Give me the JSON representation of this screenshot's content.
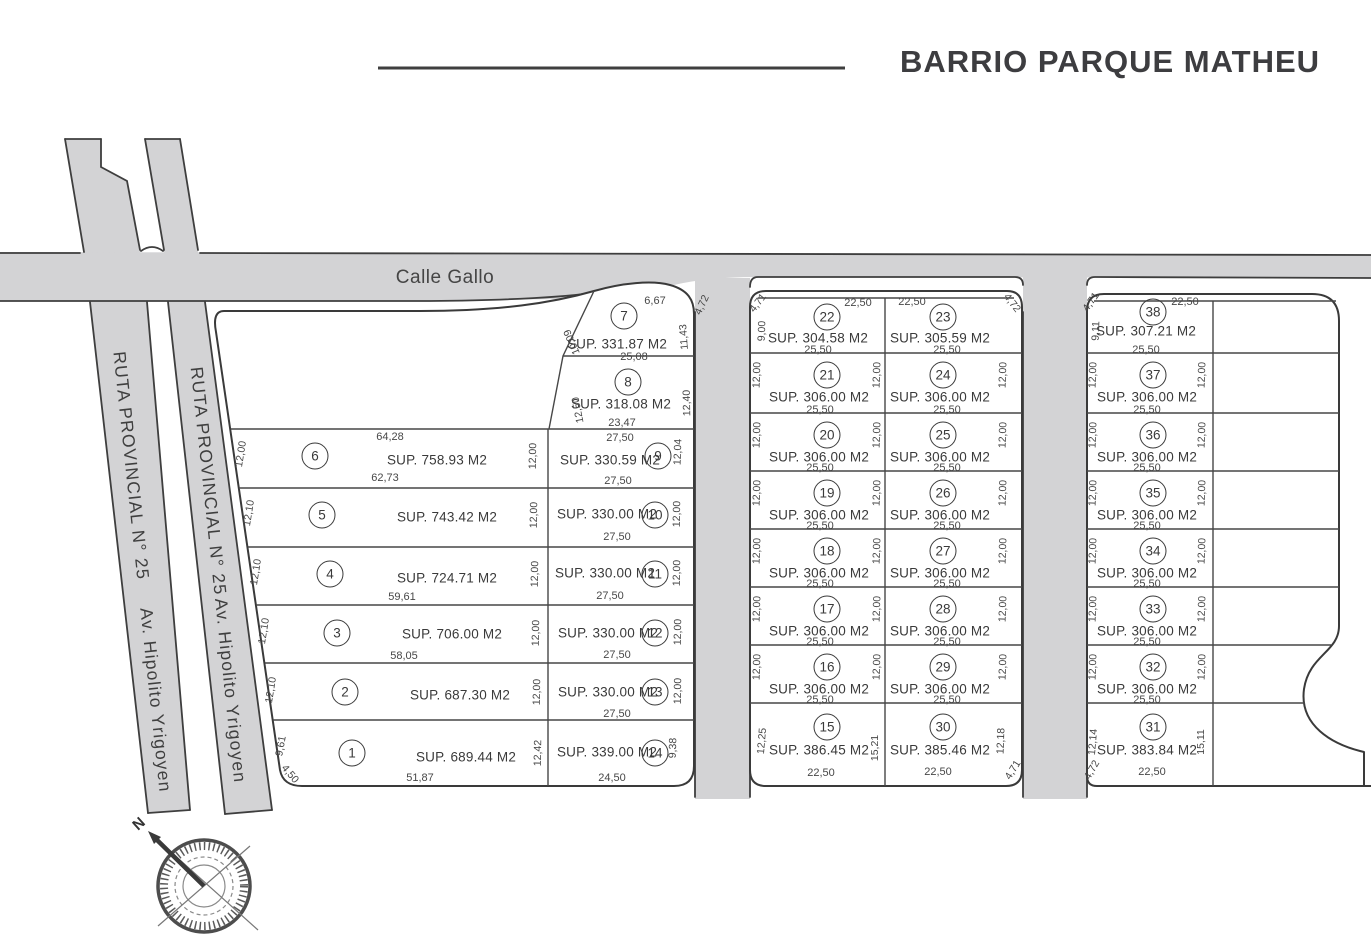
{
  "title": "BARRIO PARQUE MATHEU",
  "roads": {
    "calle_gallo": "Calle Gallo",
    "ruta_west": {
      "part1": "RUTA PROVINCIAL N° 25",
      "part2": "Av. Hipolito Yrigoyen"
    },
    "ruta_east": {
      "part1": "RUTA PROVINCIAL N° 25",
      "part2": "Av. Hipolito Yrigoyen"
    }
  },
  "compass": {
    "north": "N"
  },
  "lots": [
    {
      "number": "1",
      "sup": "SUP. 689.44 M2",
      "dims": {
        "left": "9,61",
        "corner": "4,50",
        "bottom": "51,87"
      }
    },
    {
      "number": "2",
      "sup": "SUP. 687.30 M2",
      "dims": {
        "left": "12,10"
      }
    },
    {
      "number": "3",
      "sup": "SUP. 706.00 M2",
      "dims": {
        "left": "12,10",
        "bottom": "58,05"
      }
    },
    {
      "number": "4",
      "sup": "SUP. 724.71 M2",
      "dims": {
        "left": "12,10",
        "bottom": "59,61"
      }
    },
    {
      "number": "5",
      "sup": "SUP. 743.42 M2",
      "dims": {
        "left": "12,10"
      }
    },
    {
      "number": "6",
      "sup": "SUP. 758.93 M2",
      "dims": {
        "left": "12,00",
        "top": "64,28",
        "bottom": "62,73"
      }
    },
    {
      "number": "7",
      "sup": "SUP. 331.87 M2",
      "dims": {
        "top": "6,67",
        "corner": "4,72",
        "left": "10,09",
        "right": "11,43",
        "bottom": "25,08"
      }
    },
    {
      "number": "8",
      "sup": "SUP. 318.08 M2",
      "dims": {
        "left": "12,50",
        "right": "12,40",
        "bottom": "23,47"
      }
    },
    {
      "number": "9",
      "sup": "SUP. 330.59 M2",
      "dims": {
        "top": "27,50",
        "left": "12,00",
        "right": "12,04",
        "bottom": "27,50"
      }
    },
    {
      "number": "10",
      "sup": "SUP. 330.00 M2",
      "dims": {
        "left": "12,00",
        "right": "12,00",
        "bottom": "27,50"
      }
    },
    {
      "number": "11",
      "sup": "SUP. 330.00 M2",
      "dims": {
        "left": "12,00",
        "right": "12,00",
        "bottom": "27,50"
      }
    },
    {
      "number": "12",
      "sup": "SUP. 330.00 M2",
      "dims": {
        "left": "12,00",
        "right": "12,00",
        "bottom": "27,50"
      }
    },
    {
      "number": "13",
      "sup": "SUP. 330.00 M2",
      "dims": {
        "left": "12,00",
        "right": "12,00",
        "bottom": "27,50"
      }
    },
    {
      "number": "14",
      "sup": "SUP. 339.00 M2",
      "dims": {
        "left": "12,42",
        "right": "9,38",
        "bottom": "24,50"
      }
    },
    {
      "number": "15",
      "sup": "SUP. 386.45 M2",
      "dims": {
        "left": "12,25",
        "right": "15,21",
        "bottom": "22,50"
      }
    },
    {
      "number": "16",
      "sup": "SUP. 306.00 M2",
      "dims": {
        "left": "12,00",
        "right": "12,00",
        "bottom": "25,50"
      }
    },
    {
      "number": "17",
      "sup": "SUP. 306.00 M2",
      "dims": {
        "left": "12,00",
        "right": "12,00",
        "bottom": "25,50"
      }
    },
    {
      "number": "18",
      "sup": "SUP. 306.00 M2",
      "dims": {
        "left": "12,00",
        "right": "12,00",
        "bottom": "25,50"
      }
    },
    {
      "number": "19",
      "sup": "SUP. 306.00 M2",
      "dims": {
        "left": "12,00",
        "right": "12,00",
        "bottom": "25,50"
      }
    },
    {
      "number": "20",
      "sup": "SUP. 306.00 M2",
      "dims": {
        "left": "12,00",
        "right": "12,00",
        "bottom": "25,50"
      }
    },
    {
      "number": "21",
      "sup": "SUP. 306.00 M2",
      "dims": {
        "left": "12,00",
        "right": "12,00",
        "bottom": "25,50"
      }
    },
    {
      "number": "22",
      "sup": "SUP. 304.58 M2",
      "dims": {
        "top": "22,50",
        "corner": "4,71",
        "left": "9,00",
        "bottom": "25,50"
      }
    },
    {
      "number": "23",
      "sup": "SUP. 305.59 M2",
      "dims": {
        "top": "22,50",
        "corner": "4,72",
        "bottom": "25,50"
      }
    },
    {
      "number": "24",
      "sup": "SUP. 306.00 M2",
      "dims": {
        "right": "12,00",
        "bottom": "25,50"
      }
    },
    {
      "number": "25",
      "sup": "SUP. 306.00 M2",
      "dims": {
        "right": "12,00",
        "bottom": "25,50"
      }
    },
    {
      "number": "26",
      "sup": "SUP. 306.00 M2",
      "dims": {
        "right": "12,00",
        "bottom": "25,50"
      }
    },
    {
      "number": "27",
      "sup": "SUP. 306.00 M2",
      "dims": {
        "right": "12,00",
        "bottom": "25,50"
      }
    },
    {
      "number": "28",
      "sup": "SUP. 306.00 M2",
      "dims": {
        "right": "12,00",
        "bottom": "25,50"
      }
    },
    {
      "number": "29",
      "sup": "SUP. 306.00 M2",
      "dims": {
        "right": "12,00",
        "bottom": "25,50"
      }
    },
    {
      "number": "30",
      "sup": "SUP. 385.46 M2",
      "dims": {
        "right": "12,18",
        "corner": "4,71",
        "bottom": "22,50"
      }
    },
    {
      "number": "31",
      "sup": "SUP. 383.84 M2",
      "dims": {
        "left": "12,14",
        "right": "15,11",
        "corner": "4,72",
        "bottom": "22,50"
      }
    },
    {
      "number": "32",
      "sup": "SUP. 306.00 M2",
      "dims": {
        "left": "12,00",
        "right": "12,00",
        "bottom": "25,50"
      }
    },
    {
      "number": "33",
      "sup": "SUP. 306.00 M2",
      "dims": {
        "left": "12,00",
        "right": "12,00",
        "bottom": "25,50"
      }
    },
    {
      "number": "34",
      "sup": "SUP. 306.00 M2",
      "dims": {
        "left": "12,00",
        "right": "12,00",
        "bottom": "25,50"
      }
    },
    {
      "number": "35",
      "sup": "SUP. 306.00 M2",
      "dims": {
        "left": "12,00",
        "right": "12,00",
        "bottom": "25,50"
      }
    },
    {
      "number": "36",
      "sup": "SUP. 306.00 M2",
      "dims": {
        "left": "12,00",
        "right": "12,00",
        "bottom": "25,50"
      }
    },
    {
      "number": "37",
      "sup": "SUP. 306.00 M2",
      "dims": {
        "left": "12,00",
        "right": "12,00",
        "bottom": "25,50"
      }
    },
    {
      "number": "38",
      "sup": "SUP. 307.21 M2",
      "dims": {
        "top": "22,50",
        "corner": "4,71",
        "left": "9,11",
        "bottom": "25,50"
      }
    }
  ]
}
